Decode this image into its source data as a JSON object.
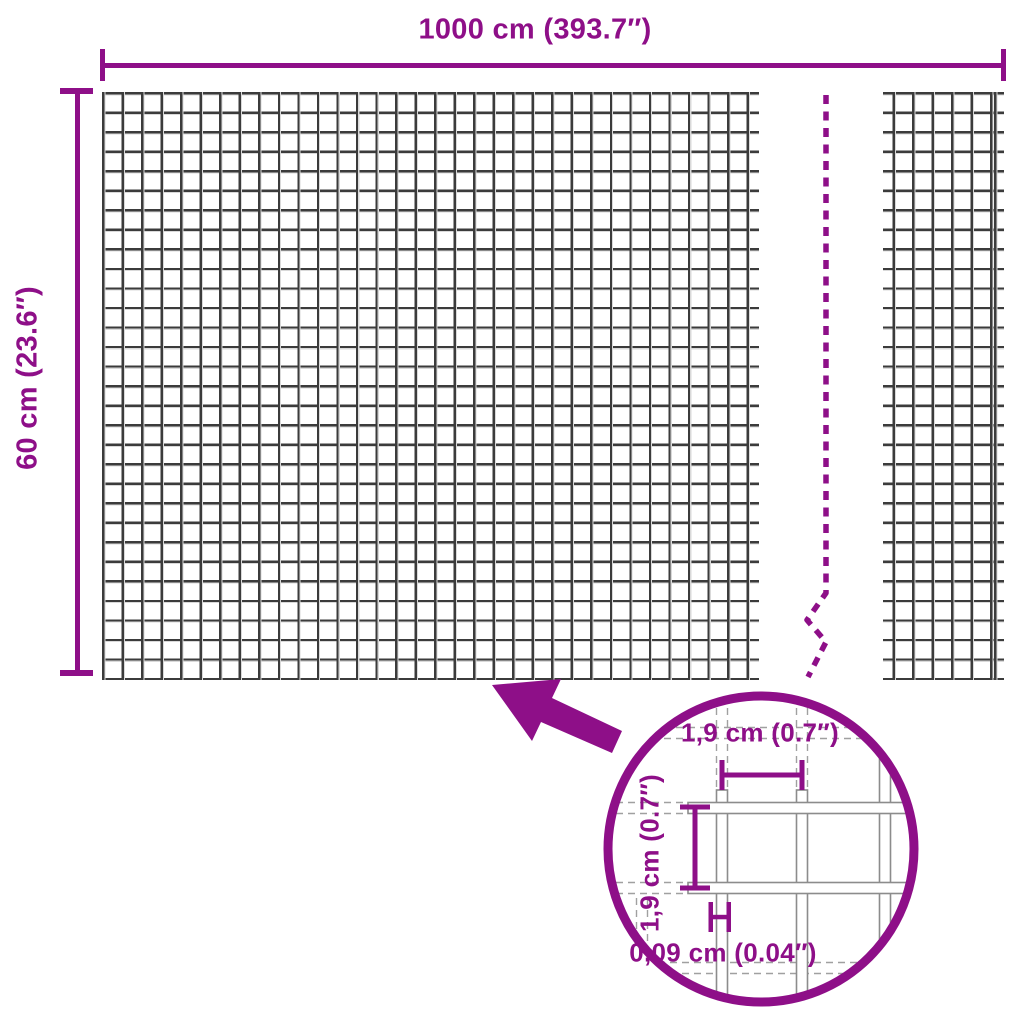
{
  "title": "Wire mesh fence dimension diagram",
  "colors": {
    "accent": "#8E0F88",
    "mesh_line": "#3B3B3B",
    "mesh_hl": "#D9D9D9",
    "wire_outline": "#8C8C8C",
    "guide": "#A0A0A0",
    "background": "#FFFFFF"
  },
  "overall": {
    "width_label": "1000 cm (393.7″)",
    "height_label": "60 cm (23.6″)"
  },
  "detail": {
    "mesh_width_label": "1,9 cm (0.7″)",
    "mesh_height_label": "1,9 cm (0.7″)",
    "wire_thickness_label": "0,09 cm (0.04″)"
  },
  "mesh": {
    "rows_visible": 30,
    "columns_visible_left_section": 33,
    "columns_visible_right_section": 6
  }
}
